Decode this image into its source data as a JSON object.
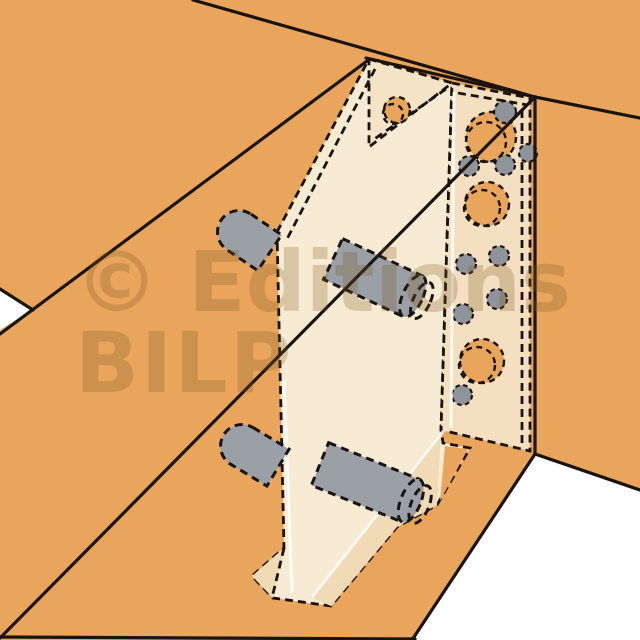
{
  "illustration": {
    "kind": "cutaway-technical-drawing",
    "subject_parts": {
      "beam": "wooden beam (top, drawn in solid outline)",
      "post": "wooden post (right, drawn in solid outline)",
      "floor_beam": "lower wooden member",
      "hanger": "concealed metal beam hanger (hidden lines, dashed)",
      "gusset": "top gusset plate of hanger",
      "blade": "vertical blade of hanger inside beam",
      "side_plate": "perforated side plate against post",
      "dowels": "4 steel dowels through beam and blade",
      "pins": "9 screw pins in side plate",
      "holes": "3 large bolt holes + 1 gusset hole"
    }
  },
  "watermark": {
    "line1": "© Editions",
    "line2": "BILP",
    "color": "#7b5a20"
  },
  "colors": {
    "background": "#ffffff",
    "wood": "#e9a55c",
    "bracket_light": "#f8ebd4",
    "bracket_mid": "#f5e3c6",
    "bracket_plate": "#f4e0c1",
    "bracket_dark": "#f1dab6",
    "steel_gray": "#9ba0a6",
    "pin_gray": "#8f939a",
    "outline": "#1a1410",
    "fold_highlight": "#ffffff"
  }
}
